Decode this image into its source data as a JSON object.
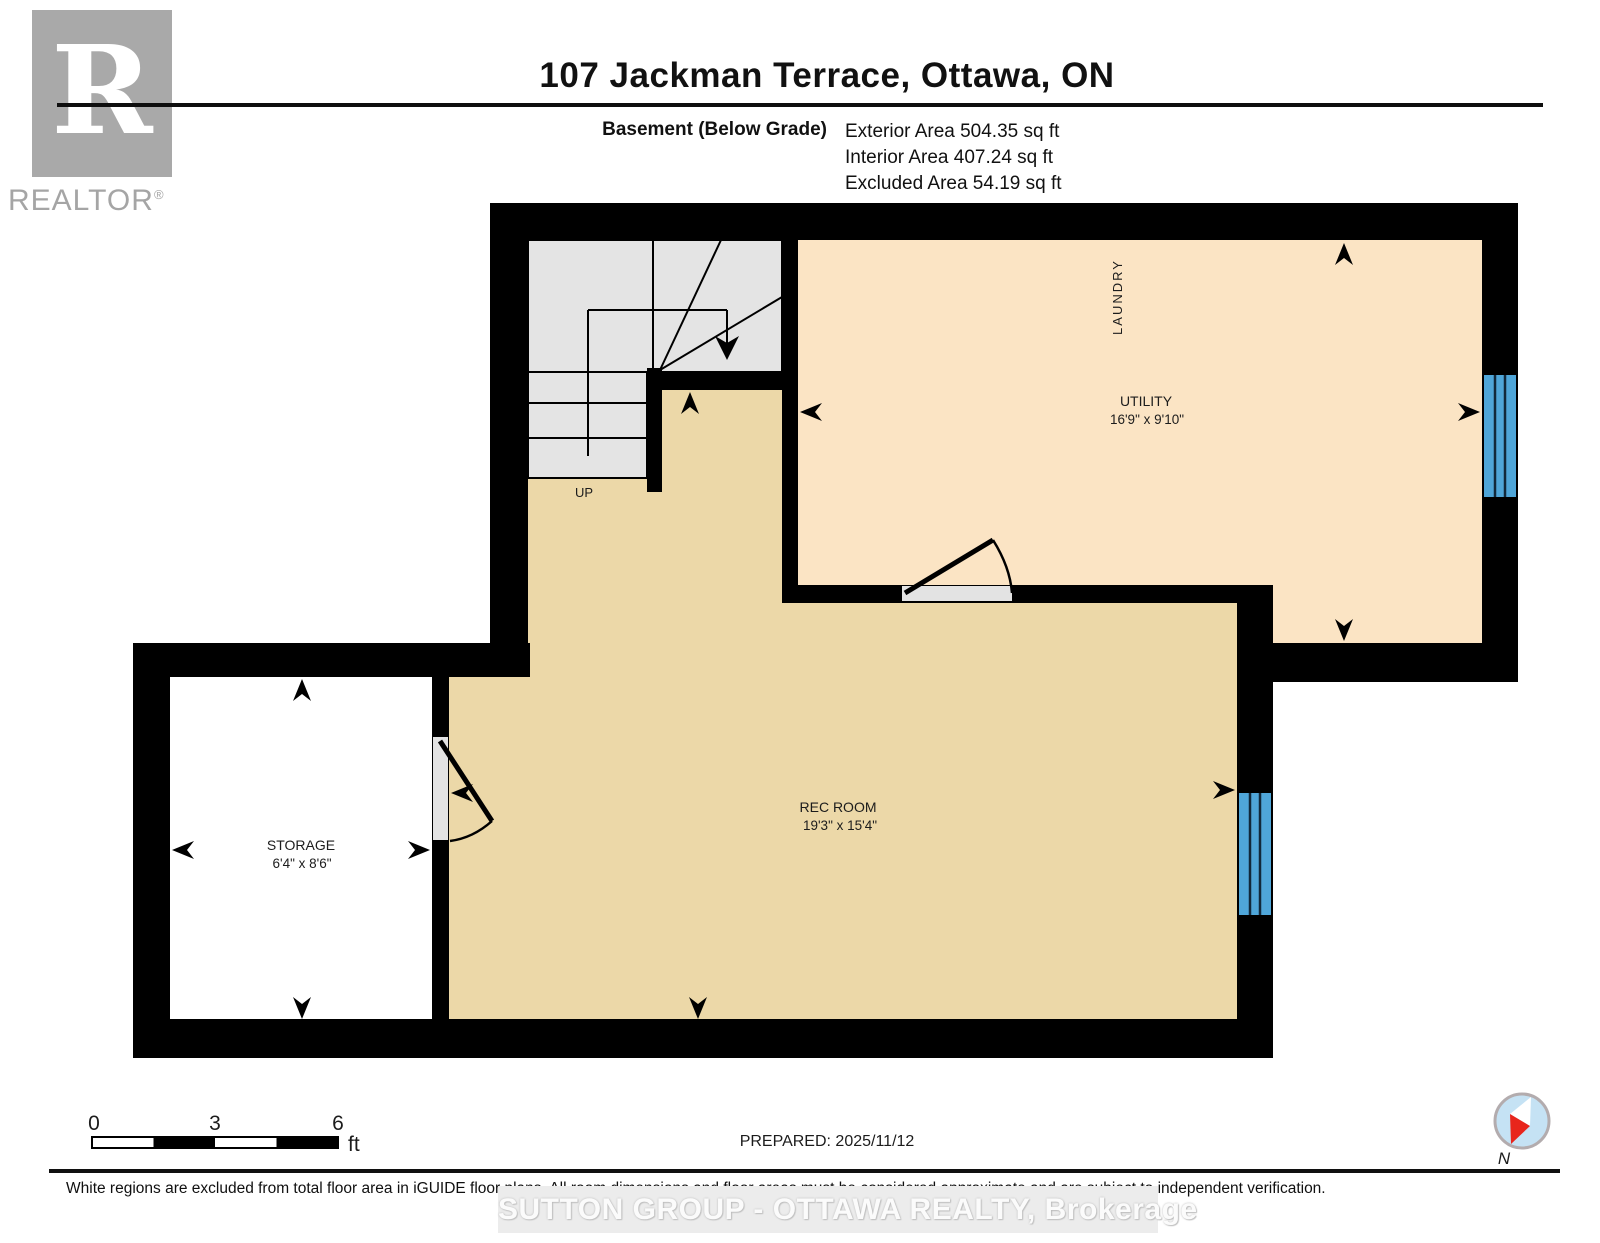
{
  "header": {
    "logo_letter": "R",
    "logo_brand": "REALTOR",
    "logo_reg": "®",
    "title": "107 Jackman Terrace, Ottawa, ON",
    "floor_label": "Basement (Below Grade)",
    "area_lines": [
      "Exterior Area 504.35 sq ft",
      "Interior Area 407.24 sq ft",
      "Excluded Area 54.19 sq ft"
    ]
  },
  "plan": {
    "rooms": [
      {
        "id": "utility",
        "label": "UTILITY",
        "dims": "16'9\" x 9'10\""
      },
      {
        "id": "rec-room",
        "label": "REC ROOM",
        "dims": "19'3\" x 15'4\""
      },
      {
        "id": "storage",
        "label": "STORAGE",
        "dims": "6'4\" x 8'6\""
      }
    ],
    "laundry_label": "LAUNDRY",
    "up_label": "UP"
  },
  "scale_bar": {
    "tick0": "0",
    "tick3": "3",
    "tick6": "6",
    "unit": "ft"
  },
  "prepared_label": "PREPARED: 2025/11/12",
  "compass": {
    "north_label": "N"
  },
  "footer": {
    "disclaimer": "White regions are excluded from total floor area in iGUIDE floor plans. All room dimensions and floor areas must be considered approximate and are subject to independent verification.",
    "watermark": "SUTTON GROUP - OTTAWA REALTY, Brokerage"
  },
  "colors": {
    "wall": "#000000",
    "utility_floor": "#fbe4c4",
    "rec_floor": "#ecd8a8",
    "stairs_floor": "#e4e4e4",
    "window_blue": "#4fa6d9",
    "excluded_floor": "#ffffff",
    "door_panel": "#e3e3e3",
    "logo_gray": "#a9a9a9",
    "compass_fill": "#c5e2f4",
    "compass_needle_red": "#e8251c"
  }
}
